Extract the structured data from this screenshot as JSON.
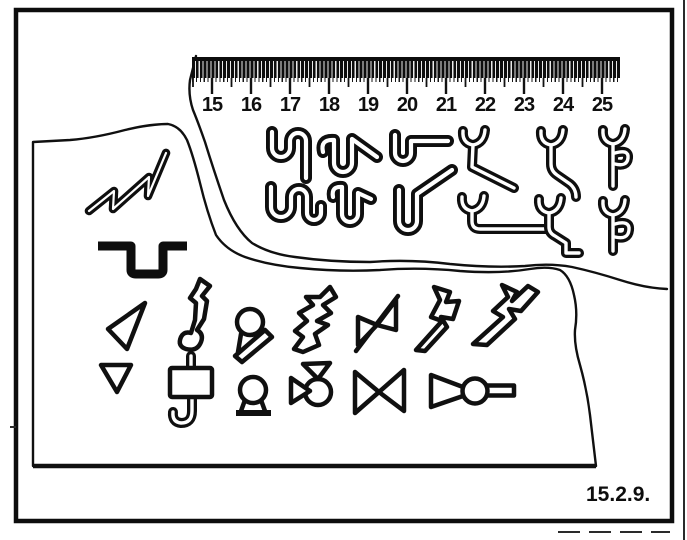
{
  "figure": {
    "label": "15.2.9."
  },
  "ruler": {
    "unit_numbers": [
      "15",
      "16",
      "17",
      "18",
      "19",
      "20",
      "21",
      "22",
      "23",
      "24",
      "25"
    ]
  },
  "shapes": {
    "upper_left_fragment": [
      "zigzag-profile-icon",
      "channel-profile-icon"
    ],
    "upper_middle_group": [
      "s-hook-profile-icon",
      "u-hook-flag-profile-icon",
      "u-hook-bar-profile-icon",
      "s-hook-curl-profile-icon",
      "u-hook-foot-profile-icon",
      "u-hook-diagonal-profile-icon"
    ],
    "upper_right_group": [
      "fork-long-leg-profile-icon",
      "fork-bent-leg-profile-icon",
      "fork-double-notch-profile-icon",
      "fork-l-foot-profile-icon",
      "fork-s-leg-profile-icon",
      "fork-double-notch-profile-icon"
    ],
    "middle_row_group": [
      "triangle-arrowhead-icon",
      "s-fold-seam-icon",
      "loop-on-slanted-base-icon",
      "zigzag-seam-icon",
      "bowtie-diagonal-icon",
      "offset-zigzag-seam-icon",
      "offset-zigzag-seam-wide-icon"
    ],
    "bottom_row_group": [
      "small-triangle-icon",
      "box-hook-seam-icon",
      "omega-loop-icon",
      "triangle-circle-cluster-icon",
      "bowtie-icon",
      "funnel-ball-stem-icon"
    ]
  },
  "colors": {
    "ink": "#101010",
    "paper": "#ffffff"
  }
}
